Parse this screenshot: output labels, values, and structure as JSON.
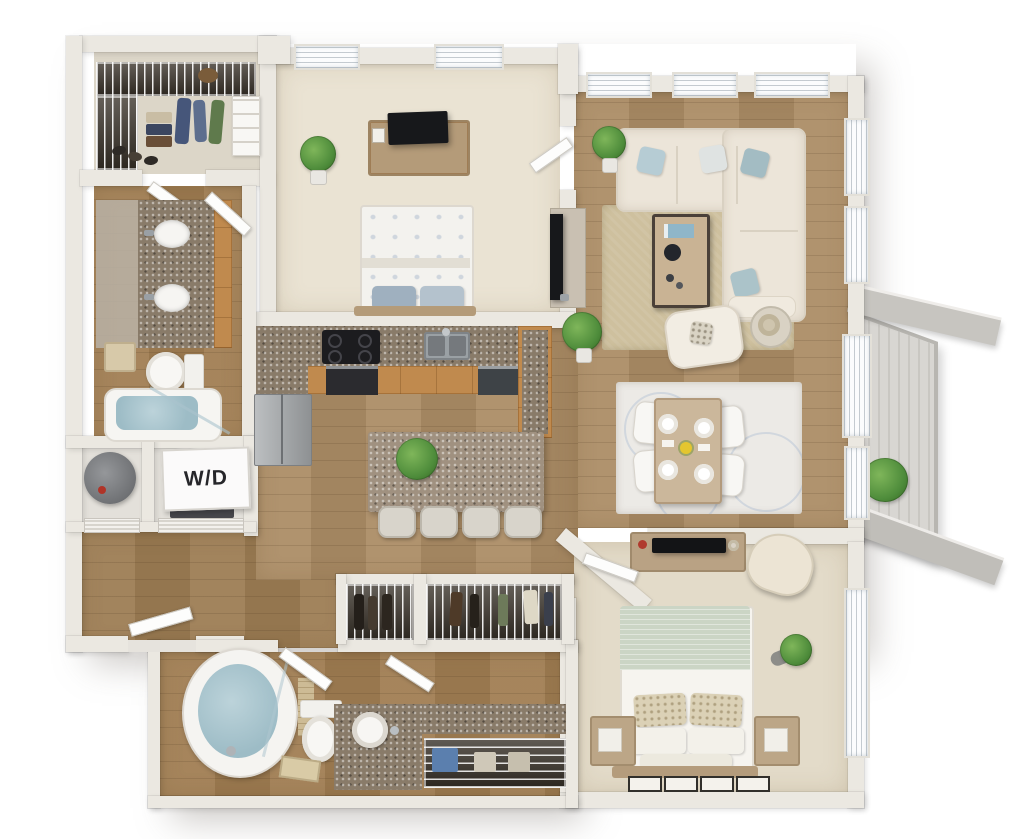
{
  "meta": {
    "type": "3d-apartment-floor-plan",
    "bedrooms": 2,
    "bathrooms": 2
  },
  "labels": {
    "washer_dryer": "W/D"
  },
  "palette": {
    "background": "#ffffff",
    "wall": "#ebe8e1",
    "wood_floor": "#ab8c65",
    "carpet": "#e8e1d1",
    "kitchen_cabinet": "#c08a4e",
    "granite": "#897b69",
    "tub_water": "#9dbcc6",
    "sofa": "#ece5d9",
    "living_rug": "#cec09e",
    "bed2_blanket": "#cbd5c5",
    "balcony_deck": "#d3d1cc",
    "plant_green": "#4e8c3b"
  },
  "rooms": [
    {
      "name": "walk-in-closet-1",
      "features": [
        "wire-shelving",
        "hanging-clothes",
        "folded-clothes",
        "shoe-rack",
        "drawer-unit"
      ]
    },
    {
      "name": "bathroom-1",
      "features": [
        "double-vanity",
        "granite-counter",
        "two-sinks",
        "mirror",
        "towel",
        "toilet",
        "shower-tub"
      ]
    },
    {
      "name": "utility-closet",
      "features": [
        "water-heater"
      ]
    },
    {
      "name": "laundry-closet",
      "label": "W/D",
      "features": [
        "stacked-washer-dryer"
      ]
    },
    {
      "name": "entry-foyer",
      "features": [
        "front-door",
        "wood-floor"
      ]
    },
    {
      "name": "bedroom-1",
      "features": [
        "bed",
        "dresser",
        "tv",
        "potted-plant",
        "two-windows",
        "door"
      ]
    },
    {
      "name": "kitchen",
      "features": [
        "l-shaped-counter",
        "range-oven",
        "double-sink",
        "dishwasher",
        "refrigerator",
        "island",
        "four-bar-stools",
        "island-plant"
      ]
    },
    {
      "name": "living-room",
      "features": [
        "sectional-sofa",
        "throw-pillows",
        "coffee-table",
        "area-rug",
        "accent-chair",
        "lamp-side-table",
        "tv-console",
        "tv",
        "potted-plants",
        "windows"
      ]
    },
    {
      "name": "dining-area",
      "features": [
        "dining-table",
        "four-chairs",
        "four-place-settings",
        "flower-centerpiece",
        "area-rug"
      ]
    },
    {
      "name": "balcony",
      "features": [
        "plank-decking",
        "potted-plant",
        "sliding-glass-door"
      ]
    },
    {
      "name": "bedroom-2",
      "features": [
        "bed",
        "dresser",
        "tv",
        "accent-chair",
        "two-nightstands",
        "wall-plant",
        "window",
        "wall-art",
        "closet"
      ]
    },
    {
      "name": "bathroom-2",
      "features": [
        "oval-soaking-tub",
        "shower-glass",
        "toilet",
        "vessel-sink-vanity",
        "granite-counter",
        "bath-mat",
        "linen-closet"
      ]
    },
    {
      "name": "hall-closets",
      "features": [
        "wire-shelving",
        "hanging-clothes",
        "storage-boxes"
      ]
    }
  ]
}
